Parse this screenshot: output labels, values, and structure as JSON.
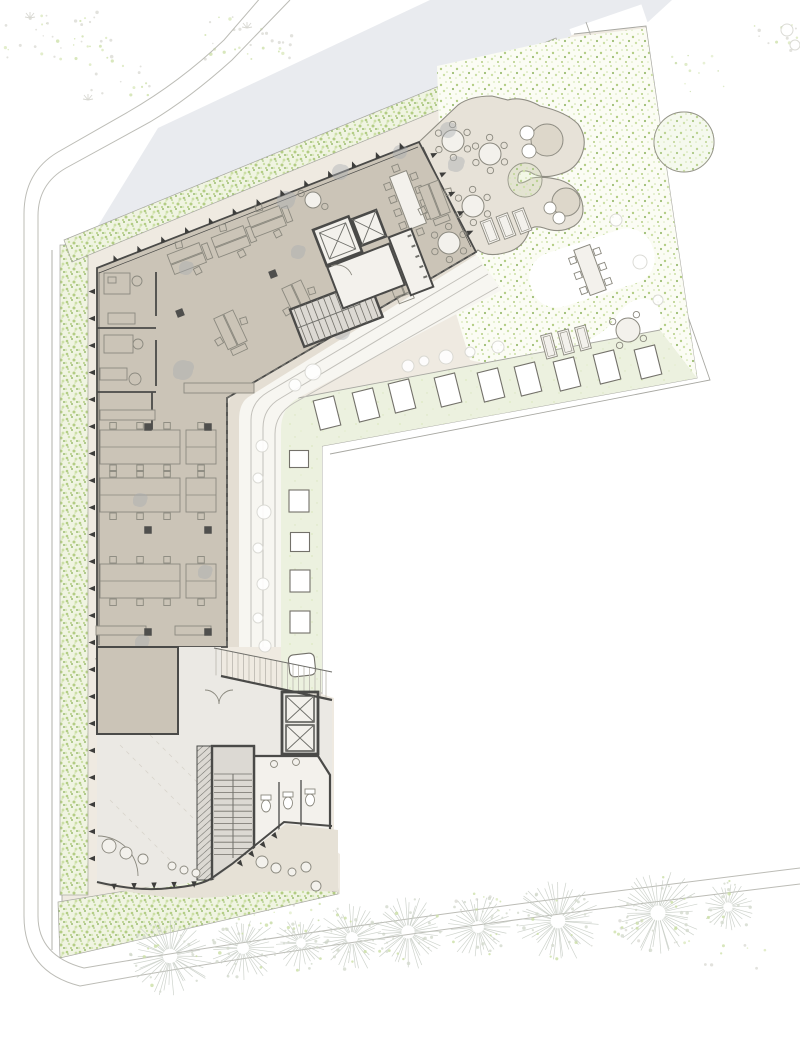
{
  "palette": {
    "paper": "#ffffff",
    "road": "#e9ebef",
    "line_road": "#bcbcb6",
    "site_line": "#a8a8a2",
    "ground": "#efeae1",
    "walk_beige": "#e4ded3",
    "walk_white": "#f7f6f1",
    "hedge_base": "#f0f4e2",
    "garden_base": "#fbfcf4",
    "pale_band": "#ecf1df",
    "floor": "#cbc4b7",
    "terrace": "#e7e2d8",
    "blob": "#ddd7ca",
    "blob_line": "#8f8d83",
    "slab": "#ebe9e4",
    "south_terrace": "#e6e1d6",
    "stair": "#dcd9d3",
    "core_room": "#f3f1ec",
    "wall": "#4a4a48",
    "wall_mid": "#6f6f6a",
    "furn": "#8b897f",
    "furn_dark": "#73716a",
    "tick": "#3e3e3c",
    "col": "#4f4f4d",
    "plant": "#a9adb2",
    "green1": "#b3cd84",
    "green2": "#cbdfa5",
    "green3": "#9cbd72",
    "green4": "#d8e7ba",
    "tree": "#c6ccc4",
    "tree_dot": "#d3d9cd",
    "ghost": "#d8d8d2",
    "white": "#ffffff"
  },
  "items": {
    "facade_ticks": [
      [
        95,
        278,
        95,
        872,
        22,
        -1
      ],
      [
        104,
        266,
        414,
        144,
        13,
        1
      ],
      [
        427,
        146,
        472,
        243,
        5,
        1
      ],
      [
        104,
        884,
        204,
        881,
        5,
        -1
      ],
      [
        233,
        866,
        279,
        829,
        4,
        -1
      ]
    ],
    "pavers_row": [
      [
        327,
        413
      ],
      [
        366,
        405
      ],
      [
        402,
        396
      ],
      [
        448,
        390
      ],
      [
        491,
        385
      ],
      [
        528,
        379
      ],
      [
        567,
        374
      ],
      [
        607,
        367
      ],
      [
        648,
        362
      ]
    ],
    "pavers_col": [
      [
        299,
        459,
        19,
        17
      ],
      [
        299,
        501,
        20,
        22
      ],
      [
        300,
        542,
        19,
        19
      ],
      [
        300,
        581,
        20,
        22
      ],
      [
        300,
        622,
        20,
        22
      ]
    ],
    "paver_bench": [
      302,
      665,
      26,
      22
    ],
    "trees": [
      [
        170,
        956,
        40
      ],
      [
        243,
        948,
        33
      ],
      [
        301,
        943,
        27
      ],
      [
        352,
        938,
        33
      ],
      [
        408,
        932,
        37
      ],
      [
        478,
        927,
        33
      ],
      [
        558,
        921,
        41
      ],
      [
        658,
        913,
        42
      ],
      [
        728,
        907,
        26
      ]
    ],
    "round_tables": [
      [
        453,
        141,
        11,
        6,
        0
      ],
      [
        490,
        154,
        11,
        6,
        0
      ],
      [
        473,
        206,
        11,
        6,
        0
      ],
      [
        449,
        243,
        11,
        6,
        0
      ],
      [
        628,
        330,
        12,
        4,
        0
      ],
      [
        141,
        697,
        15,
        8,
        1
      ],
      [
        313,
        200,
        8,
        2,
        0
      ]
    ],
    "rect_tables": [
      {
        "x": 408,
        "y": 200,
        "w": 18,
        "h": 56,
        "rot": -21,
        "ch": [
          [
            -14,
            -20
          ],
          [
            -14,
            -6
          ],
          [
            -14,
            8
          ],
          [
            -14,
            22
          ],
          [
            14,
            -20
          ],
          [
            14,
            -6
          ],
          [
            14,
            8
          ],
          [
            14,
            22
          ],
          [
            0,
            -34
          ],
          [
            0,
            34
          ]
        ]
      },
      {
        "x": 590,
        "y": 270,
        "w": 17,
        "h": 48,
        "rot": -20,
        "ch": [
          [
            -13,
            -15
          ],
          [
            -13,
            1
          ],
          [
            -13,
            17
          ],
          [
            13,
            -15
          ],
          [
            13,
            1
          ],
          [
            13,
            17
          ]
        ]
      },
      {
        "x": 126,
        "y": 788,
        "w": 25,
        "h": 52,
        "rot": -2,
        "ch": [
          [
            -13,
            -17
          ],
          [
            -13,
            0
          ],
          [
            -13,
            17
          ],
          [
            13,
            -17
          ],
          [
            13,
            0
          ],
          [
            13,
            17
          ],
          [
            0,
            -31
          ],
          [
            0,
            31
          ]
        ]
      },
      {
        "x": 171,
        "y": 786,
        "w": 25,
        "h": 52,
        "rot": -2,
        "ch": [
          [
            -13,
            -17
          ],
          [
            -13,
            0
          ],
          [
            -13,
            17
          ],
          [
            13,
            -17
          ],
          [
            13,
            0
          ],
          [
            13,
            17
          ],
          [
            0,
            -31
          ],
          [
            0,
            31
          ]
        ]
      }
    ],
    "desk_clusters": [
      [
        187,
        259,
        -21
      ],
      [
        231,
        242,
        -21
      ],
      [
        267,
        222,
        -21
      ],
      [
        230,
        330,
        65
      ],
      [
        298,
        300,
        65
      ],
      [
        398,
        278,
        69
      ],
      [
        434,
        200,
        69
      ]
    ],
    "bench_rows": [
      [
        100,
        447,
        80
      ],
      [
        186,
        447,
        30
      ],
      [
        100,
        495,
        80
      ],
      [
        186,
        495,
        30
      ],
      [
        100,
        581,
        80
      ],
      [
        186,
        581,
        30
      ]
    ],
    "sideboards": [
      [
        100,
        410,
        55,
        10
      ],
      [
        96,
        626,
        50,
        9
      ],
      [
        175,
        626,
        36,
        9
      ],
      [
        184,
        383,
        70,
        10
      ]
    ],
    "columns": [
      [
        180,
        313,
        -21
      ],
      [
        273,
        274,
        -21
      ],
      [
        148,
        427,
        0
      ],
      [
        208,
        427,
        0
      ],
      [
        148,
        530,
        0
      ],
      [
        208,
        530,
        0
      ],
      [
        148,
        632,
        0
      ],
      [
        208,
        632,
        0
      ],
      [
        107,
        731,
        0
      ],
      [
        152,
        731,
        0
      ]
    ],
    "plants": [
      [
        286,
        200,
        9
      ],
      [
        186,
        268,
        7
      ],
      [
        183,
        370,
        10
      ],
      [
        342,
        332,
        8
      ],
      [
        456,
        164,
        8
      ],
      [
        340,
        172,
        8
      ],
      [
        400,
        152,
        7
      ],
      [
        448,
        130,
        8
      ],
      [
        140,
        500,
        7
      ],
      [
        205,
        572,
        7
      ],
      [
        142,
        642,
        7
      ],
      [
        110,
        706,
        8
      ],
      [
        155,
        842,
        8
      ],
      [
        298,
        252,
        7
      ]
    ],
    "bushes": [
      [
        408,
        366,
        6
      ],
      [
        424,
        361,
        5
      ],
      [
        446,
        357,
        7
      ],
      [
        470,
        352,
        5
      ],
      [
        498,
        347,
        6
      ],
      [
        313,
        372,
        8
      ],
      [
        295,
        385,
        6
      ],
      [
        262,
        446,
        6
      ],
      [
        258,
        478,
        5
      ],
      [
        264,
        512,
        7
      ],
      [
        258,
        548,
        5
      ],
      [
        263,
        584,
        6
      ],
      [
        258,
        618,
        5
      ],
      [
        265,
        646,
        6
      ],
      [
        616,
        220,
        6
      ],
      [
        640,
        262,
        7
      ],
      [
        658,
        300,
        5
      ],
      [
        787,
        30,
        6
      ],
      [
        795,
        45,
        5
      ]
    ],
    "veg_clusters": [
      [
        60,
        35,
        55,
        26,
        42
      ],
      [
        250,
        38,
        48,
        22,
        30
      ],
      [
        390,
        86,
        40,
        20,
        24
      ],
      [
        120,
        80,
        30,
        16,
        14
      ],
      [
        775,
        40,
        22,
        18,
        12
      ],
      [
        140,
        915,
        30,
        14,
        14
      ],
      [
        300,
        900,
        40,
        12,
        12
      ],
      [
        480,
        902,
        40,
        12,
        10
      ],
      [
        640,
        930,
        50,
        16,
        14
      ],
      [
        735,
        955,
        30,
        14,
        8
      ]
    ],
    "flecks": [
      [
        390,
        372,
        30,
        8,
        12
      ],
      [
        470,
        356,
        30,
        8,
        10
      ],
      [
        296,
        520,
        8,
        60,
        14
      ],
      [
        610,
        250,
        16,
        40,
        12
      ],
      [
        200,
        912,
        120,
        20,
        40
      ],
      [
        700,
        80,
        30,
        30,
        12
      ]
    ],
    "sprigs": [
      [
        88,
        100
      ],
      [
        247,
        28
      ],
      [
        398,
        82
      ],
      [
        30,
        18
      ]
    ],
    "loungers": [
      [
        490,
        231,
        12,
        24,
        -21
      ],
      [
        506,
        226,
        12,
        24,
        -21
      ],
      [
        522,
        221,
        12,
        24,
        -21
      ],
      [
        549,
        346,
        11,
        24,
        -15
      ],
      [
        566,
        342,
        11,
        24,
        -15
      ],
      [
        583,
        338,
        11,
        24,
        -15
      ],
      [
        449,
        240,
        16,
        10,
        -21
      ],
      [
        465,
        248,
        16,
        10,
        -21
      ],
      [
        109,
        660,
        24,
        11,
        -18
      ],
      [
        131,
        669,
        22,
        10,
        -40
      ],
      [
        288,
        829,
        26,
        11,
        -8
      ],
      [
        320,
        864,
        13,
        27,
        4
      ]
    ],
    "blob_circles": [
      [
        547,
        140,
        16
      ],
      [
        566,
        202,
        14
      ]
    ],
    "blob_smalls": [
      [
        527,
        133,
        7
      ],
      [
        529,
        151,
        7
      ],
      [
        550,
        208,
        6
      ],
      [
        559,
        218,
        6
      ]
    ],
    "green_circles": [
      [
        525,
        180,
        17
      ],
      [
        684,
        142,
        30
      ]
    ],
    "poufs": [
      [
        109,
        846,
        7
      ],
      [
        126,
        853,
        6
      ],
      [
        143,
        859,
        5
      ],
      [
        172,
        866,
        4
      ],
      [
        184,
        870,
        4
      ],
      [
        196,
        873,
        4
      ],
      [
        262,
        862,
        6
      ],
      [
        276,
        868,
        5
      ],
      [
        292,
        872,
        4
      ],
      [
        306,
        867,
        5
      ],
      [
        316,
        886,
        5
      ]
    ],
    "wc_toilets": [
      [
        266,
        806
      ],
      [
        288,
        803
      ],
      [
        310,
        800
      ]
    ],
    "pergola": {
      "x0": 216,
      "x1": 330,
      "step": 5.5
    },
    "stair_lower": {
      "x0": 214,
      "x1": 250,
      "y0": 774,
      "y1": 858,
      "step": 6.2
    }
  }
}
